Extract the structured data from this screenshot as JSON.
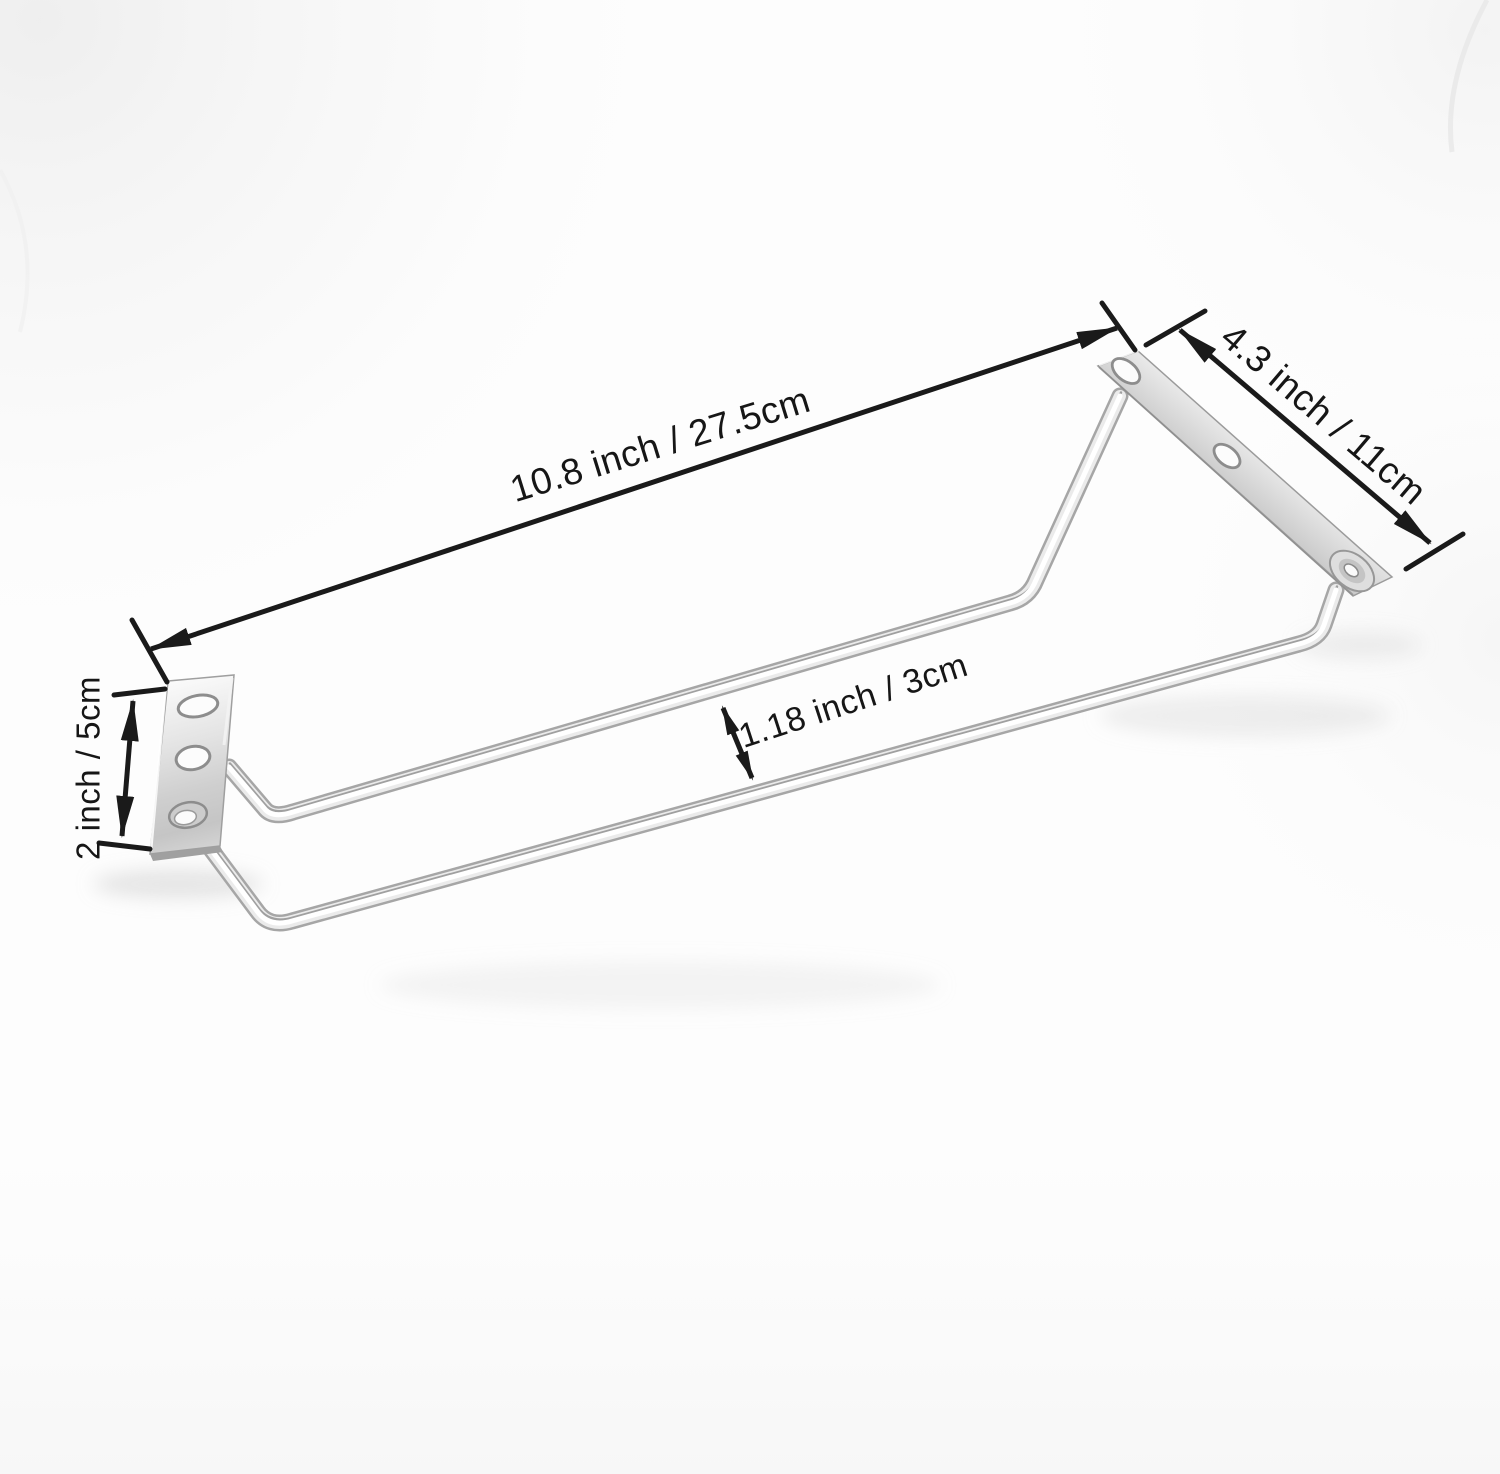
{
  "image": {
    "description": "Chrome wire stemware glass hanger rack with two mounting plates, photographed on a white background with dimension callouts"
  },
  "annotations": {
    "rail_length": {
      "label": "10.8 inch / 27.5cm"
    },
    "bracket_length": {
      "label": "4.3 inch / 11cm"
    },
    "plate_width": {
      "label": "2 inch / 5cm"
    },
    "rail_gap": {
      "label": "1.18 inch / 3cm"
    }
  },
  "colors": {
    "annotation_ink": "#1a1a1a",
    "metal_highlight": "#ffffff",
    "metal_light": "#ebebeb",
    "metal_mid": "#c9c9c9",
    "metal_dark": "#8f8f8f",
    "background": "#fdfdfd"
  }
}
